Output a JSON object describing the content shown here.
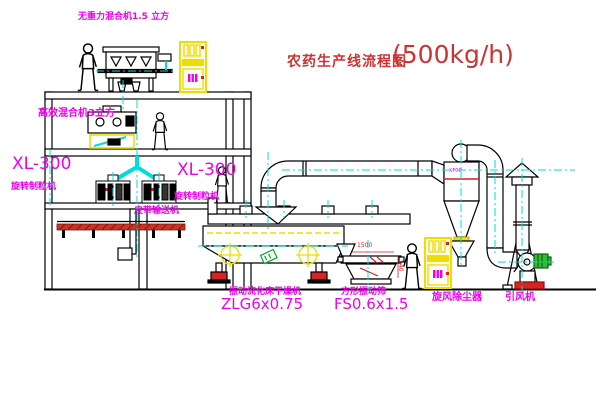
{
  "title": {
    "name": "农药生产线流程图",
    "capacity": "(500kg/h)"
  },
  "equipment_labels": {
    "gravity_mixer": "无重力混合机1.5 立方",
    "efficient_mixer": "高效混合机3立方",
    "granulator_left_model": "XL-300",
    "granulator_left_name": "旋转制粒机",
    "granulator_right_model": "XL-300",
    "granulator_right_name": "旋转制粒机",
    "belt_conveyor": "皮带输送机",
    "dryer_name": "振动流化床干燥机",
    "dryer_model": "ZLG6x0.75",
    "screen_name": "方形振动筛",
    "screen_model": "FS0.6x1.5",
    "cyclone": "旋风除尘器",
    "fan": "引风机"
  },
  "dimensions": {
    "screen_width": "1500",
    "screen_height": "540"
  },
  "annotations": {
    "cyclone_tag": "XF00"
  },
  "colors": {
    "label": "#ee00ee",
    "title": "#cc3333",
    "centerline": "#00dcdc",
    "cabinet_yellow": "#eedd00",
    "alert_red": "#dd2222",
    "motor_green": "#33bb33",
    "line_black": "#000000",
    "background": "#ffffff"
  }
}
